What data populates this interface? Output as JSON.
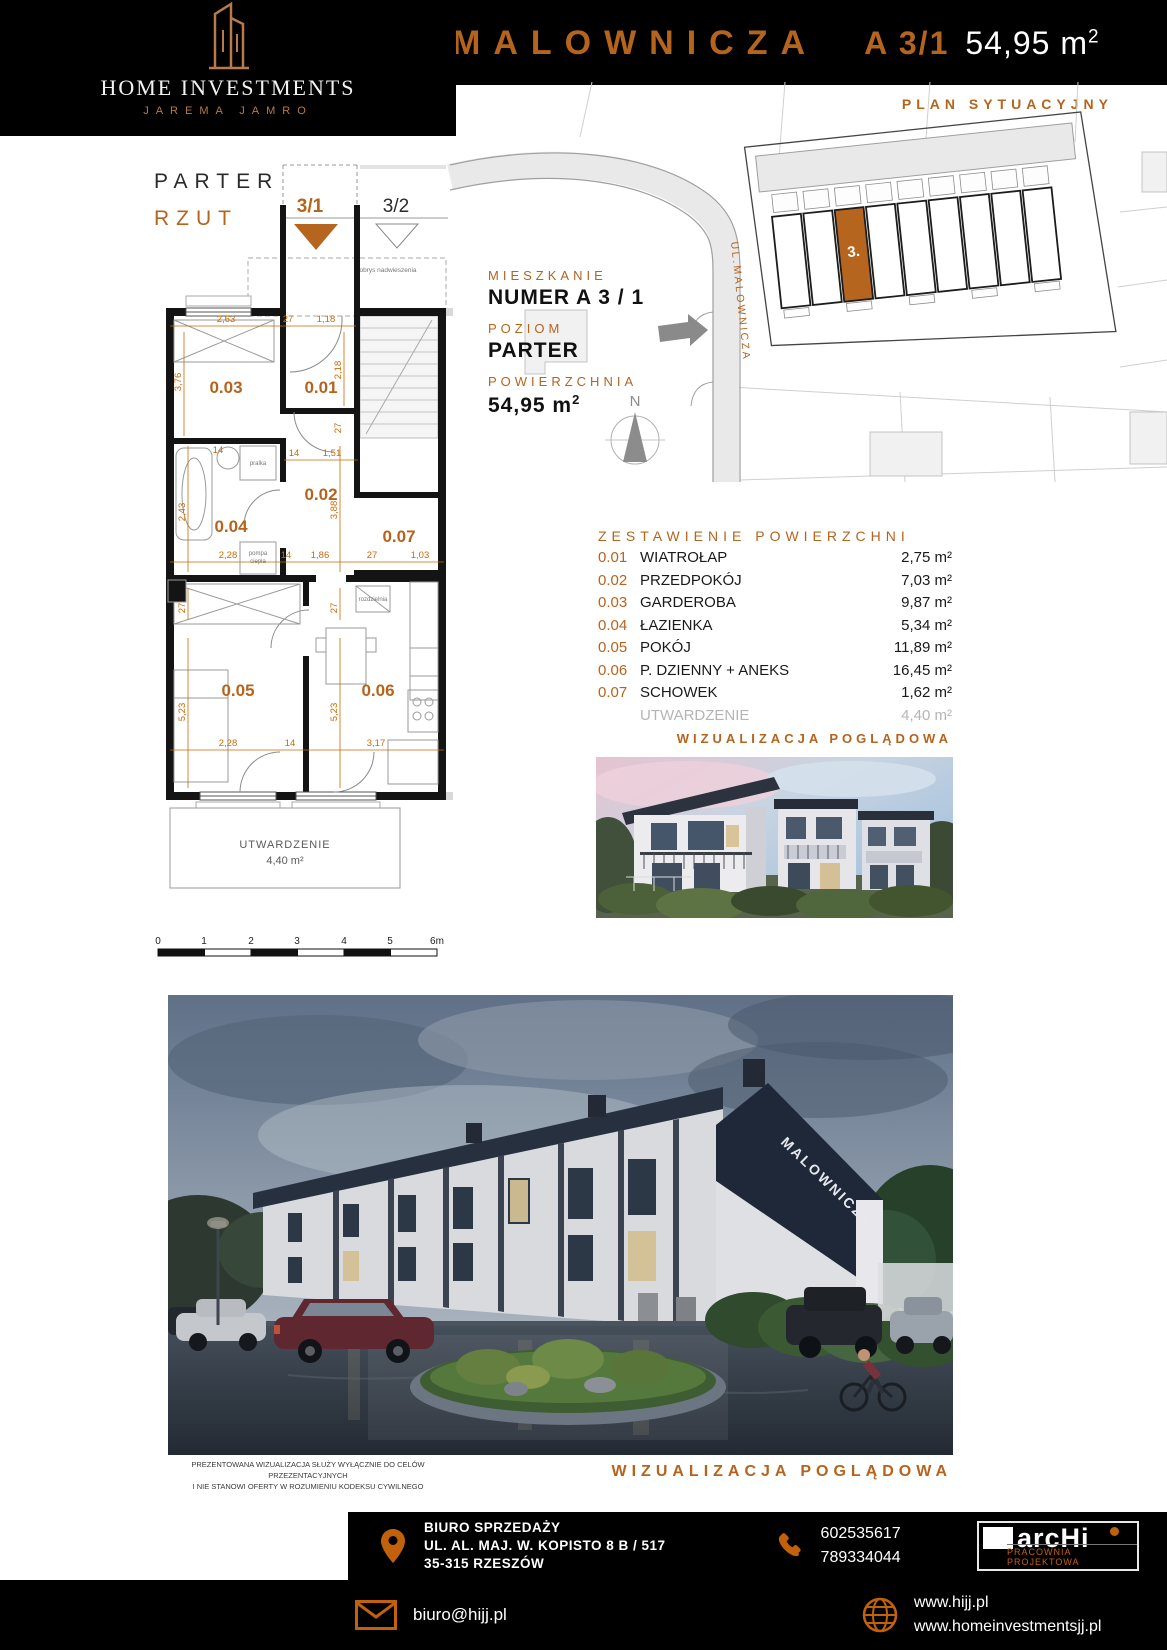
{
  "colors": {
    "accent": "#b5641e",
    "plan_dim": "#c96a05",
    "wall": "#141414",
    "muted_gray": "#b5b5b5",
    "highlight_unit": "#b5651d"
  },
  "header": {
    "brand_line1": "HOME INVESTMENTS",
    "brand_line2": "JAREMA JAMRO",
    "title": "MALOWNICZA",
    "unit": "A 3/1",
    "area": "54,95 m",
    "area_sup": "2",
    "site_plan_label": "PLAN SYTUACYJNY"
  },
  "plan": {
    "floor_label": "PARTER",
    "view_label": "RZUT",
    "marker_this": "3/1",
    "marker_next": "3/2",
    "overhang": "obrys nadwieszenia",
    "rooms": {
      "r1": "0.01",
      "r2": "0.02",
      "r3": "0.03",
      "r4": "0.04",
      "r5": "0.05",
      "r6": "0.06",
      "r7": "0.07"
    },
    "dims": {
      "t1": "2,63",
      "t2": "27",
      "t3": "1,18",
      "v376": "3,76",
      "v218": "2,18",
      "v27a": "27",
      "d14a": "14",
      "d151": "1,51",
      "d14b": "14",
      "v243": "2,43",
      "v388": "3,88",
      "m1": "2,28",
      "m2": "14",
      "m3": "1,86",
      "m4": "27",
      "m5": "1,03",
      "v27b": "27",
      "v27c": "27",
      "v523a": "5,23",
      "v523b": "5,23",
      "b1": "2,28",
      "b2": "14",
      "b3": "3,17"
    },
    "fixtures": {
      "washer": "pralka",
      "heat1": "pompa",
      "heat2": "ciepła",
      "board": "rozdzielnia"
    },
    "utw_label": "UTWARDZENIE",
    "utw_area": "4,40 m²",
    "scale_ticks": [
      "0",
      "1",
      "2",
      "3",
      "4",
      "5",
      "6m"
    ]
  },
  "site_plan": {
    "street": "UL.MALOWNICZA",
    "unit_number": "3.",
    "north": "N"
  },
  "info": {
    "label1": "MIESZKANIE",
    "value1": "NUMER A 3 / 1",
    "label2": "POZIOM",
    "value2": "PARTER",
    "label3": "POWIERZCHNIA",
    "value3": "54,95 m",
    "value3_sup": "2"
  },
  "areas": {
    "title": "ZESTAWIENIE POWIERZCHNI",
    "rows": [
      {
        "code": "0.01",
        "name": "WIATROŁAP",
        "value": "2,75 m²"
      },
      {
        "code": "0.02",
        "name": "PRZEDPOKÓJ",
        "value": "7,03 m²"
      },
      {
        "code": "0.03",
        "name": "GARDEROBA",
        "value": "9,87 m²"
      },
      {
        "code": "0.04",
        "name": "ŁAZIENKA",
        "value": "5,34 m²"
      },
      {
        "code": "0.05",
        "name": "POKÓJ",
        "value": "11,89 m²"
      },
      {
        "code": "0.06",
        "name": "P. DZIENNY + ANEKS",
        "value": "16,45 m²"
      },
      {
        "code": "0.07",
        "name": "SCHOWEK",
        "value": "1,62 m²"
      }
    ],
    "extra": {
      "name": "UTWARDZENIE",
      "value": "4,40 m²"
    }
  },
  "viz_label_top": "WIZUALIZACJA POGLĄDOWA",
  "viz_label_bottom": "WIZUALIZACJA POGLĄDOWA",
  "render": {
    "gable_text": "MALOWNICZA"
  },
  "disclaimer": {
    "line1": "PREZENTOWANA WIZUALIZACJA SŁUŻY WYŁĄCZNIE DO CELÓW PRZEZENTACYJNYCH",
    "line2": "I NIE STANOWI OFERTY W ROZUMIENIU KODEKSU CYWILNEGO"
  },
  "footer": {
    "office_title": "BIURO SPRZEDAŻY",
    "address_line1": "UL. AL. MAJ. W. KOPISTO 8 B / 517",
    "address_line2": "35-315 RZESZÓW",
    "phone1": "602535617",
    "phone2": "789334044",
    "email": "biuro@hijj.pl",
    "web1": "www.hijj.pl",
    "web2": "www.homeinvestmentsjj.pl",
    "archi_name": "arcHi",
    "archi_sub": "PRACOWNIA PROJEKTOWA"
  }
}
